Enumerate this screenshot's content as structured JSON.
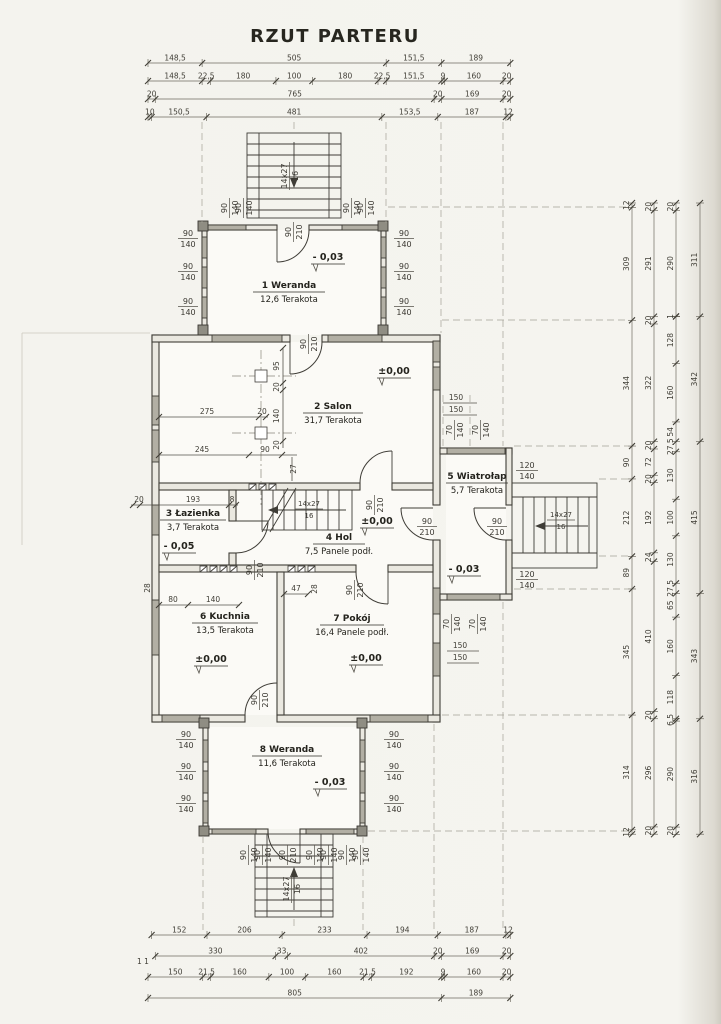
{
  "title": "RZUT PARTERU",
  "rooms": [
    {
      "id": "1",
      "title": "1 Weranda",
      "sub": "12,6 Terakota",
      "level": "- 0,03"
    },
    {
      "id": "2",
      "title": "2 Salon",
      "sub": "31,7 Terakota",
      "level": "±0,00"
    },
    {
      "id": "3",
      "title": "3 Łazienka",
      "sub": "3,7 Terakota",
      "level": "- 0,05"
    },
    {
      "id": "4",
      "title": "4 Hol",
      "sub": "7,5 Panele podł.",
      "level": "±0,00"
    },
    {
      "id": "5",
      "title": "5 Wiatrołap",
      "sub": "5,7 Terakota",
      "level": "- 0,03"
    },
    {
      "id": "6",
      "title": "6 Kuchnia",
      "sub": "13,5 Terakota",
      "level": "±0,00"
    },
    {
      "id": "7",
      "title": "7 Pokój",
      "sub": "16,4 Panele podł.",
      "level": "±0,00"
    },
    {
      "id": "8",
      "title": "8 Weranda",
      "sub": "11,6 Terakota",
      "level": "- 0,03"
    }
  ],
  "labels": {
    "door_w": "90",
    "door_h": "210",
    "win_w": "90",
    "win_h": "140",
    "win120_w": "120",
    "win120_h": "140",
    "win70_w": "70",
    "win70_h": "140",
    "s150": "150",
    "stairs_run": "14x27",
    "stairs_rise": "16",
    "section": "1 1"
  },
  "dims": {
    "top": [
      [
        "148,5",
        "505",
        "151,5",
        "189"
      ],
      [
        "148,5",
        "22,5",
        "180",
        "100",
        "180",
        "22,5",
        "151,5",
        "9",
        "160",
        "20"
      ],
      [
        "20",
        "765",
        "20",
        "169",
        "20"
      ],
      [
        "10",
        "150,5",
        "481",
        "153,5",
        "187",
        "12"
      ]
    ],
    "bottom": [
      [
        "152",
        "206",
        "233",
        "194",
        "187",
        "12"
      ],
      [
        "330",
        "33",
        "402",
        "20",
        "169",
        "20"
      ],
      [
        "150",
        "21,5",
        "160",
        "100",
        "160",
        "21,5",
        "192",
        "9",
        "160",
        "20"
      ],
      [
        "805",
        "189"
      ]
    ],
    "right": [
      [
        "12",
        "309",
        "344",
        "90",
        "212",
        "89",
        "345",
        "314",
        "12"
      ],
      [
        "20",
        "291",
        "20",
        "322",
        "20",
        "72",
        "20",
        "192",
        "24",
        "410",
        "20",
        "296",
        "20"
      ],
      [
        "20",
        "290",
        "1",
        "128",
        "160",
        "54",
        "27,5",
        "130",
        "100",
        "130",
        "27,5",
        "65",
        "160",
        "118",
        "6,5",
        "290",
        "20"
      ],
      [
        "311",
        "342",
        "415",
        "343",
        "316"
      ]
    ],
    "inner": {
      "v95": "95",
      "v20a": "20",
      "v140": "140",
      "v20b": "20",
      "h275": "275",
      "h20": "20",
      "h245": "245",
      "h90": "90",
      "v27": "27",
      "w20": "20",
      "w193": "193",
      "w8": "8",
      "k28": "28",
      "k80": "80",
      "k140": "140",
      "p47": "47",
      "p28": "28"
    }
  }
}
